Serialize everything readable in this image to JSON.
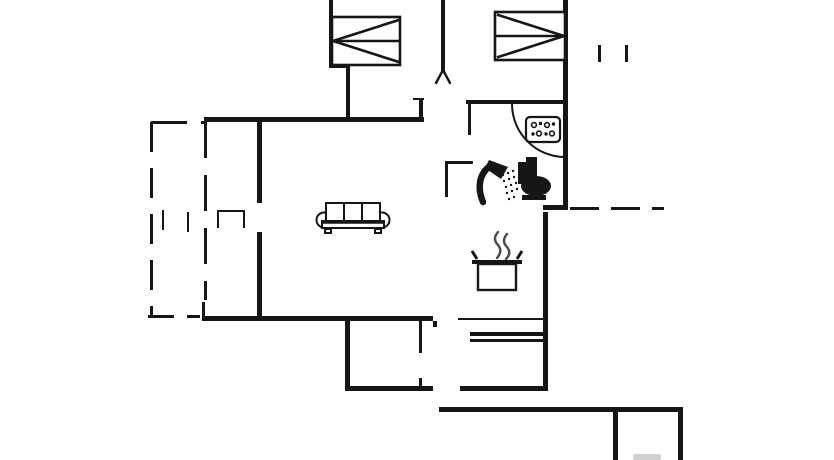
{
  "canvas": {
    "w": 834,
    "h": 460,
    "bg": "#ffffff",
    "ink": "#161616",
    "steam_color": "#4a4a4a",
    "smudge_color": "#c8c8c8"
  },
  "walls": [
    {
      "x": 329,
      "y": 0,
      "w": 4,
      "h": 68
    },
    {
      "x": 329,
      "y": 64,
      "w": 21,
      "h": 4
    },
    {
      "x": 346,
      "y": 64,
      "w": 4,
      "h": 58
    },
    {
      "x": 441,
      "y": 0,
      "w": 4,
      "h": 71
    },
    {
      "x": 563,
      "y": 0,
      "w": 5,
      "h": 210
    },
    {
      "x": 204,
      "y": 117,
      "w": 220,
      "h": 5
    },
    {
      "x": 413,
      "y": 98,
      "w": 11,
      "h": 2
    },
    {
      "x": 419,
      "y": 100,
      "w": 4,
      "h": 19
    },
    {
      "x": 257,
      "y": 122,
      "w": 5,
      "h": 81
    },
    {
      "x": 257,
      "y": 232,
      "w": 5,
      "h": 86
    },
    {
      "x": 202,
      "y": 302,
      "w": 3,
      "h": 16
    },
    {
      "x": 202,
      "y": 316,
      "w": 231,
      "h": 5
    },
    {
      "x": 345,
      "y": 321,
      "w": 5,
      "h": 66
    },
    {
      "x": 345,
      "y": 386,
      "w": 88,
      "h": 5
    },
    {
      "x": 460,
      "y": 386,
      "w": 88,
      "h": 5
    },
    {
      "x": 543,
      "y": 212,
      "w": 5,
      "h": 179
    },
    {
      "x": 543,
      "y": 205,
      "w": 25,
      "h": 5
    },
    {
      "x": 419,
      "y": 321,
      "w": 3,
      "h": 32
    },
    {
      "x": 419,
      "y": 378,
      "w": 3,
      "h": 13
    },
    {
      "x": 433,
      "y": 321,
      "w": 4,
      "h": 6
    },
    {
      "x": 458,
      "y": 318,
      "w": 87,
      "h": 2
    },
    {
      "x": 470,
      "y": 332,
      "w": 75,
      "h": 4
    },
    {
      "x": 470,
      "y": 339,
      "w": 75,
      "h": 3
    },
    {
      "x": 466,
      "y": 100,
      "w": 101,
      "h": 4
    },
    {
      "x": 468,
      "y": 104,
      "w": 3,
      "h": 31
    },
    {
      "x": 445,
      "y": 161,
      "w": 28,
      "h": 3
    },
    {
      "x": 445,
      "y": 161,
      "w": 3,
      "h": 36
    },
    {
      "x": 439,
      "y": 407,
      "w": 244,
      "h": 5
    },
    {
      "x": 613,
      "y": 412,
      "w": 5,
      "h": 48
    },
    {
      "x": 678,
      "y": 412,
      "w": 5,
      "h": 48
    },
    {
      "x": 598,
      "y": 45,
      "w": 3,
      "h": 17
    },
    {
      "x": 625,
      "y": 45,
      "w": 3,
      "h": 17
    },
    {
      "x": 162,
      "y": 210,
      "w": 2,
      "h": 20
    },
    {
      "x": 187,
      "y": 212,
      "w": 2,
      "h": 20
    }
  ],
  "dashes": [
    {
      "x": 150,
      "y": 122,
      "len": 193,
      "dir": "v",
      "dash": 30,
      "gap": 16,
      "t": 3
    },
    {
      "x": 151,
      "y": 121,
      "len": 53,
      "dir": "h",
      "dash": 36,
      "gap": 14,
      "t": 3
    },
    {
      "x": 204,
      "y": 122,
      "len": 178,
      "dir": "v",
      "dash": 36,
      "gap": 17,
      "t": 3
    },
    {
      "x": 148,
      "y": 315,
      "len": 52,
      "dir": "h",
      "dash": 26,
      "gap": 13,
      "t": 3
    },
    {
      "x": 570,
      "y": 207,
      "len": 94,
      "dir": "h",
      "dash": 29,
      "gap": 12,
      "t": 3
    }
  ],
  "icons": {
    "bed-left": {
      "x": 332,
      "y": 17,
      "label": "double-bed"
    },
    "bed-right": {
      "x": 495,
      "y": 12,
      "label": "double-bed"
    },
    "sofa": {
      "x": 316,
      "y": 202,
      "label": "three-seat-sofa"
    },
    "hob": {
      "x": 526,
      "y": 117,
      "label": "dotted-hob-panel"
    },
    "shower": {
      "x": 477,
      "y": 158,
      "label": "shower"
    },
    "toilet": {
      "x": 514,
      "y": 157,
      "label": "toilet"
    },
    "pot": {
      "x": 472,
      "y": 232,
      "label": "cooking-pot-with-steam"
    },
    "fork": {
      "x": 443,
      "y": 70,
      "label": "wall-end-fork"
    },
    "door-arc": {
      "x": 511,
      "y": 104,
      "w": 54,
      "h": 54,
      "label": "door-swing"
    },
    "fireplace": {
      "x": 217,
      "y": 210,
      "w": 28,
      "h": 18,
      "label": "open-box-fixture"
    },
    "smudge": {
      "x": 633,
      "y": 454,
      "w": 28,
      "h": 6,
      "label": "cropped-mark"
    }
  }
}
